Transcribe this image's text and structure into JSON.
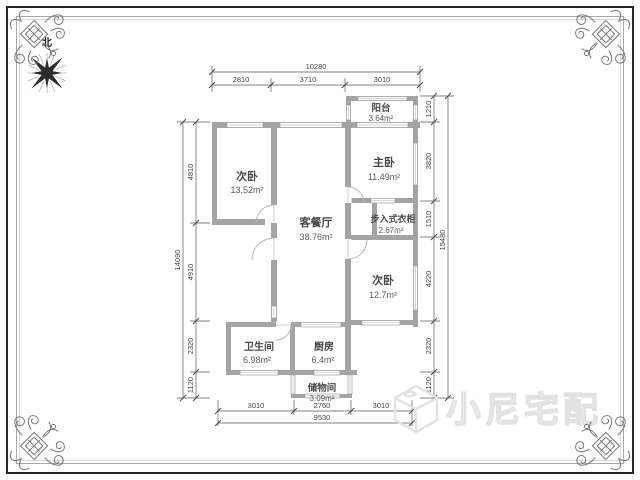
{
  "compass": {
    "north_label": "北"
  },
  "rooms": [
    {
      "name": "次卧",
      "area": "13.52m²"
    },
    {
      "name": "客餐厅",
      "area": "38.76m²"
    },
    {
      "name": "主卧",
      "area": "11.49m²"
    },
    {
      "name": "阳台",
      "area": "3.64m²"
    },
    {
      "name": "步入式衣柜",
      "area": "2.67m²"
    },
    {
      "name": "次卧",
      "area": "12.7m²"
    },
    {
      "name": "卫生间",
      "area": "6.98m²"
    },
    {
      "name": "厨房",
      "area": "6.4m²"
    },
    {
      "name": "储物间",
      "area": "3.09m²"
    }
  ],
  "dimensions": {
    "top": {
      "total": "10280",
      "segments": [
        "2810",
        "3710",
        "3010"
      ]
    },
    "bottom": {
      "total": "9530",
      "segments": [
        "3010",
        "2760",
        "3010"
      ]
    },
    "left": {
      "total": "14090",
      "segments": [
        "4810",
        "4910",
        "2320",
        "1120"
      ]
    },
    "right": {
      "total": "15480",
      "segments": [
        "1210",
        "3820",
        "1510",
        "4220",
        "2320",
        "1120"
      ]
    }
  },
  "watermark": {
    "text": "小尼宅配"
  },
  "colors": {
    "wall": "#a4a4a4",
    "dimension": "#555555",
    "label": "#484848",
    "watermark": "#e2e2e2",
    "border": "#262626",
    "ornament": "#787878"
  }
}
